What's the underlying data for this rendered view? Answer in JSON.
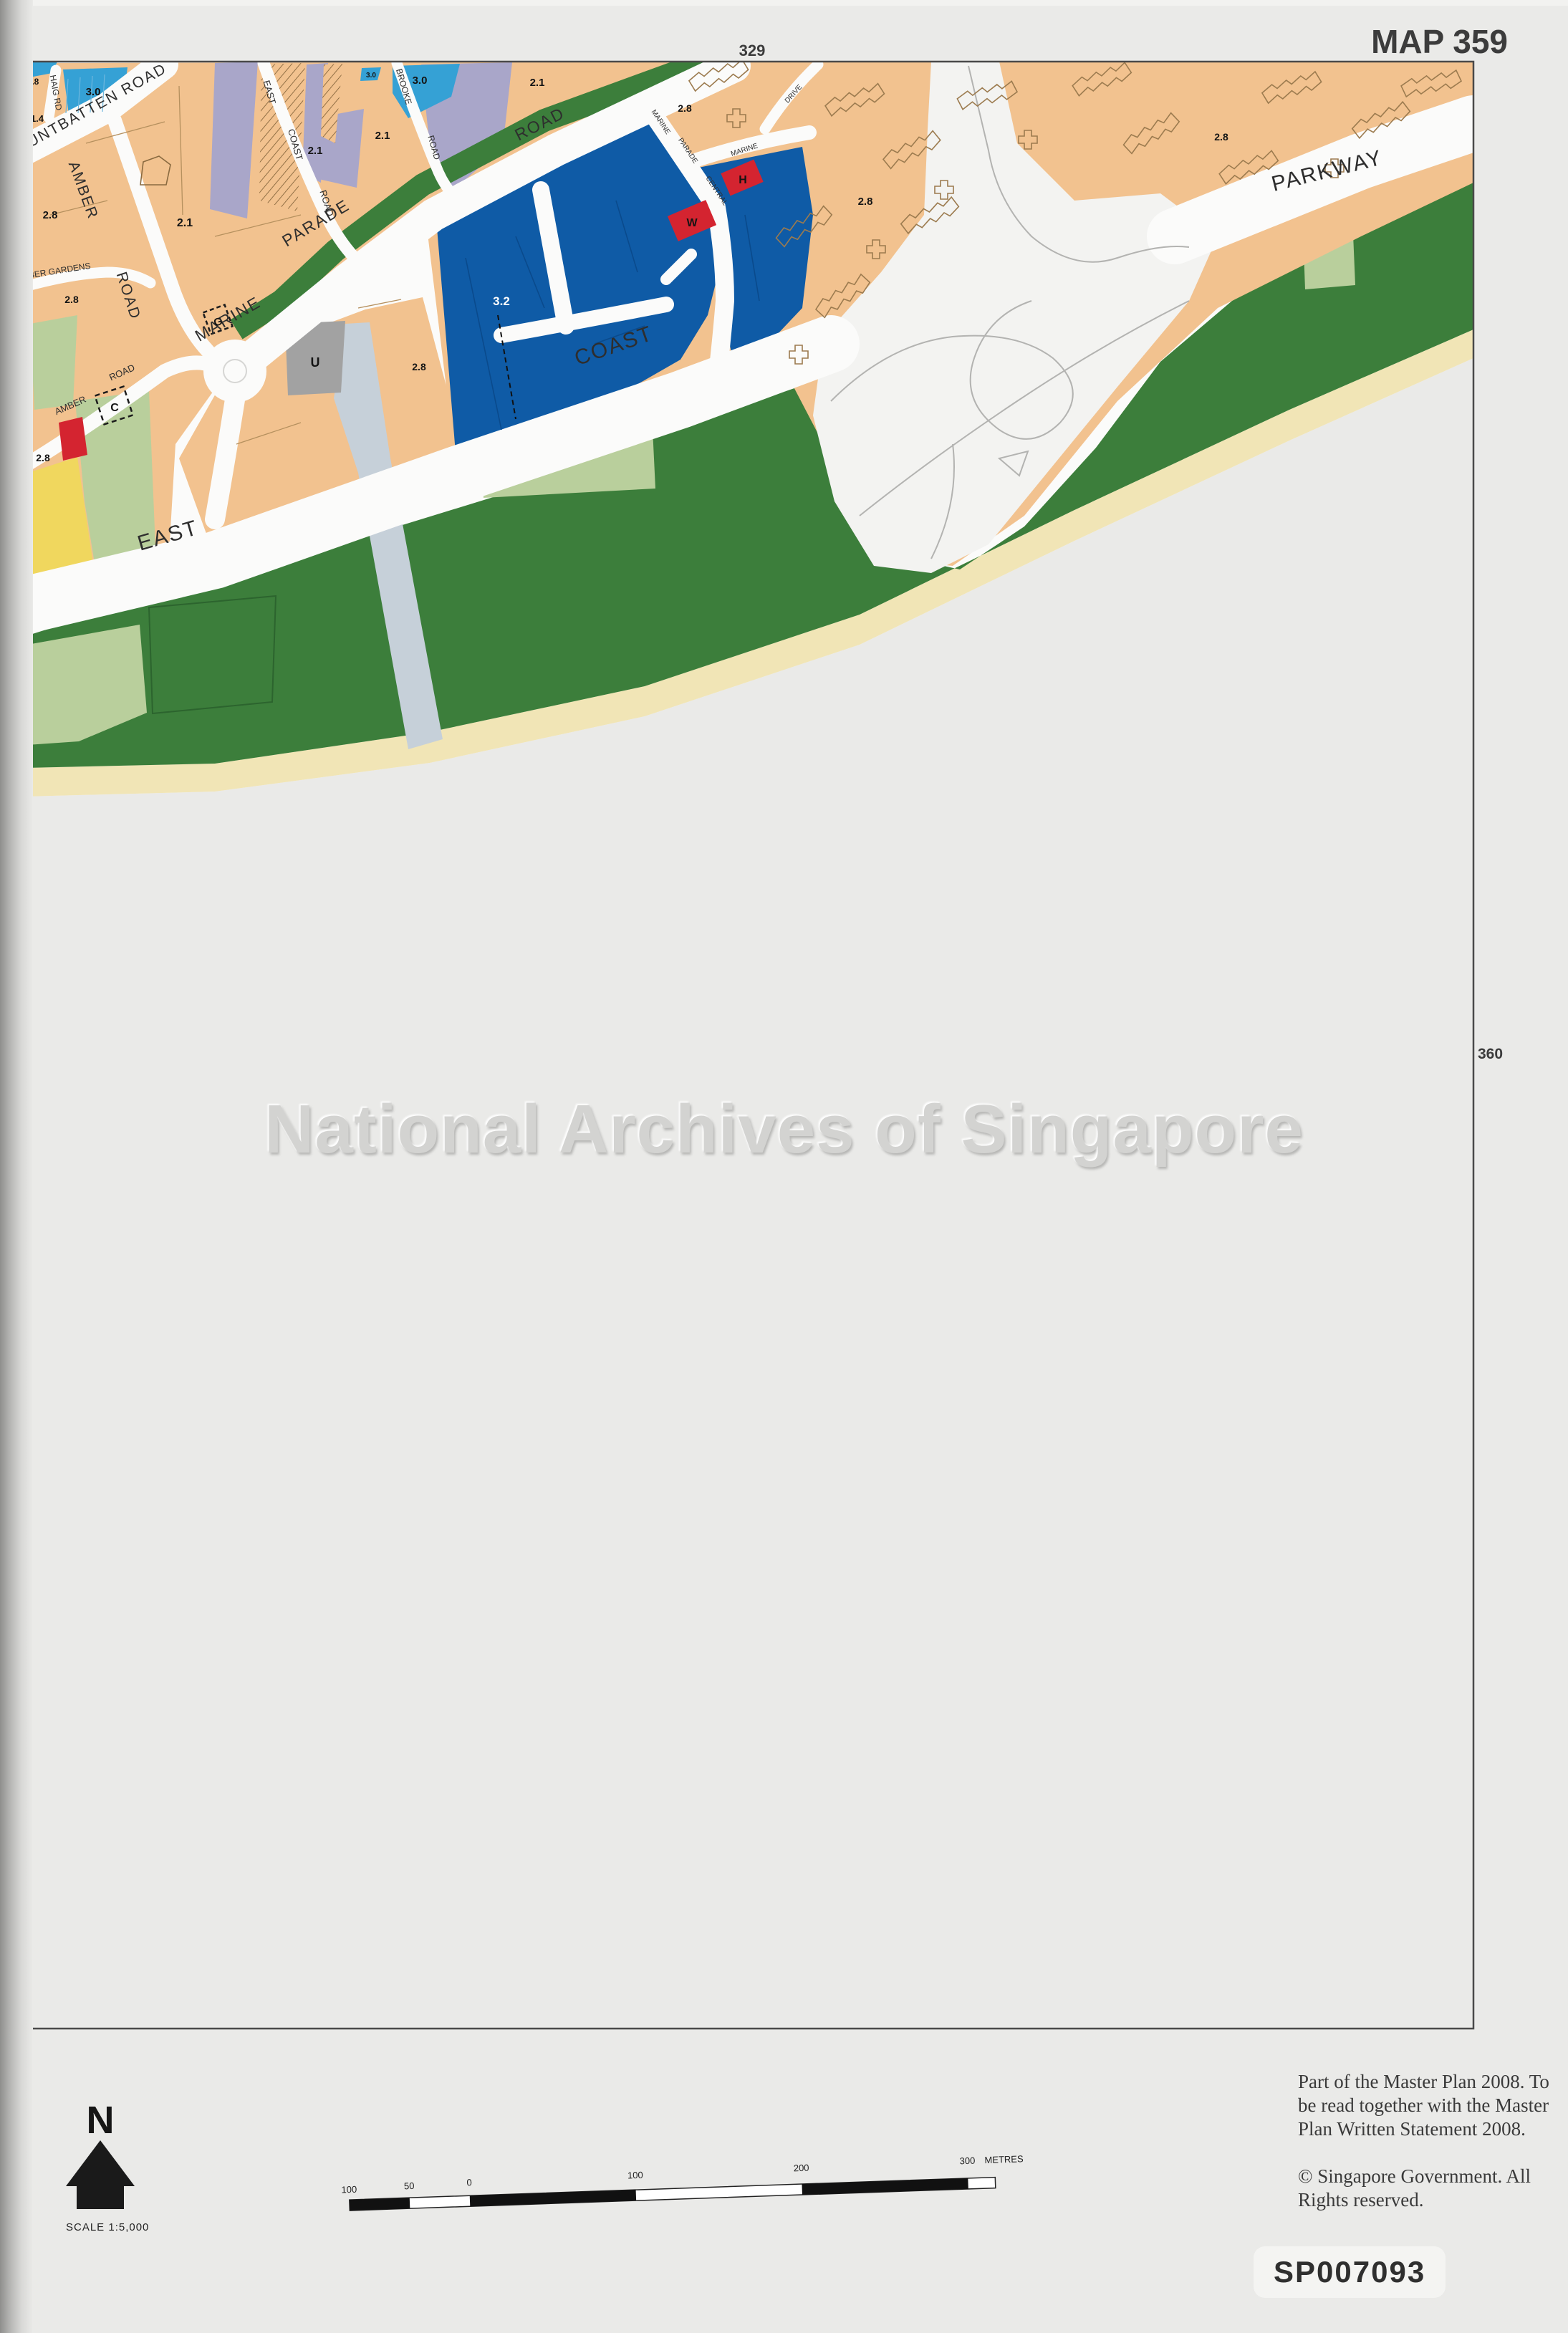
{
  "page": {
    "map_number": "MAP 359",
    "adjacent_top": "329",
    "adjacent_left": "358",
    "adjacent_right": "360",
    "watermark": "National Archives of Singapore",
    "footnote": "Part of the Master Plan 2008. To be read together with the Master Plan Written Statement 2008.",
    "copyright": "©  Singapore Government. All Rights reserved.",
    "reference_code": "SP007093"
  },
  "legend": {
    "north_label": "N",
    "scale_label": "SCALE  1:5,000",
    "scale_ticks": [
      "100",
      "50",
      "0",
      "100",
      "200",
      "300"
    ],
    "scale_units": "METRES"
  },
  "map_labels": {
    "mountbatten": "MOUNTBATTEN  ROAD",
    "haig": "HAIG RD",
    "amber_upper": "AMBER",
    "amber_upper_road": "ROAD",
    "amber_gardens": "AMBER   GARDENS",
    "amber_lower": "AMBER",
    "amber_lower_road": "ROAD",
    "east_coast_rd": [
      "EAST",
      "COAST",
      "ROAD"
    ],
    "brooke": [
      "BROOKE",
      "ROAD"
    ],
    "marine_parade": [
      "MARINE",
      "PARADE",
      "ROAD"
    ],
    "mp_central": [
      "MARINE",
      "PARADE",
      "CENTRAL"
    ],
    "marine_small": "MARINE",
    "drive": "DRIVE",
    "expressway": [
      "EAST",
      "COAST",
      "PARKWAY"
    ]
  },
  "plot_ratios": {
    "r28_corner": "2.8",
    "r14": "1.4",
    "r30_left": "3.0",
    "r21_main": "2.1",
    "r28_amber": "2.8",
    "r28_gardens": "2.8",
    "r28_south": "2.8",
    "r21_ecr": "2.1",
    "r21_mid": "2.1",
    "r30_small": "3.0",
    "r30_brooke": "3.0",
    "r21_brooke": "2.1",
    "r32_blue": "3.2",
    "r28_canal": "2.8",
    "r28_mp": "2.8",
    "r28_drive": "2.8",
    "r28_parkway": "2.8"
  },
  "site_letters": {
    "u": "U",
    "c": "C",
    "g": "G",
    "w": "W",
    "h": "H"
  },
  "colors": {
    "residential_orange": "#f2c28f",
    "commercial_blue": "#0f5ba6",
    "residential_high_blue": "#35a1d5",
    "civic_lavender": "#a9a6c9",
    "park_green": "#3c7e3b",
    "open_space_pale_green": "#b9cf9c",
    "beach_sand": "#f1e5b6",
    "reserve_yellow": "#f0d75e",
    "red_site": "#d42430",
    "utility_gray": "#a2a2a2",
    "road_white": "#fbfbfa",
    "canal_blue": "#c6d0d9"
  }
}
